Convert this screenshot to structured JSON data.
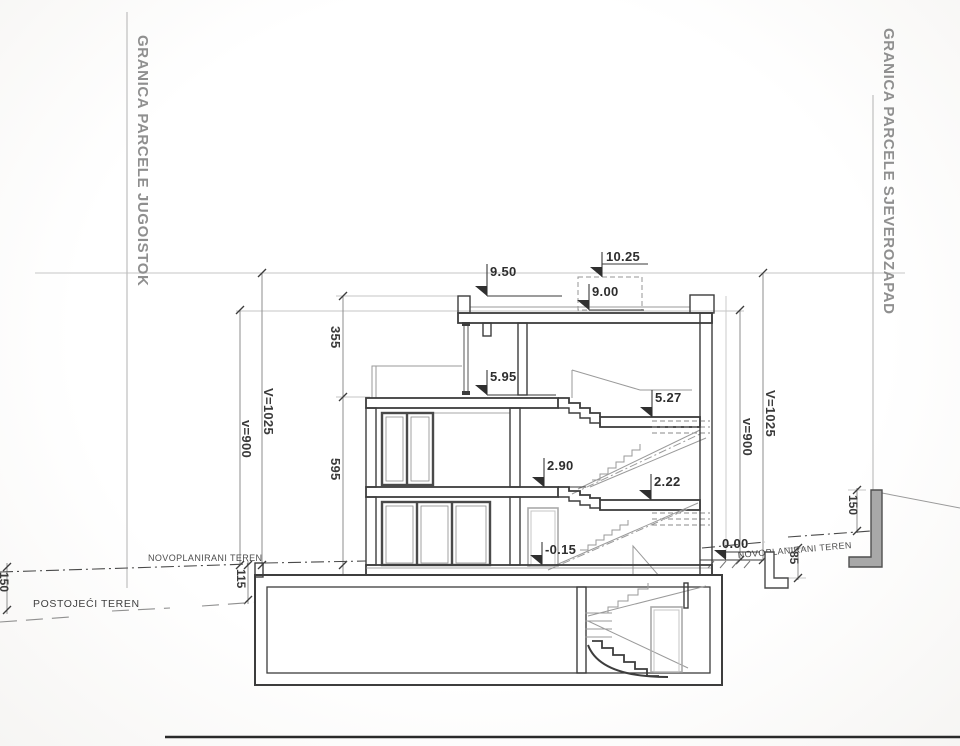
{
  "boundary": {
    "left": "GRANICA PARCELE JUGOISTOK",
    "right": "GRANICA PARCELE SJEVEROZAPAD"
  },
  "levels": {
    "stair_overrun": "10.25",
    "parapet": "9.50",
    "roof": "9.00",
    "top_floor": "5.95",
    "upper_landing": "5.27",
    "first_floor": "2.90",
    "lower_landing": "2.22",
    "ground_floor": "-0.15",
    "terrain_zero": "0.00"
  },
  "dimensions": {
    "roof_to_top_floor": "355",
    "top_floor_to_zero": "595",
    "left_total_V": "V=1025",
    "left_total_v": "v=900",
    "right_total_V": "V=1025",
    "right_total_v": "v=900",
    "terrain_step_left": "115",
    "terrain_drop_far_left": "150",
    "retaining_wall_right": "150",
    "terrain_step_right": "85"
  },
  "terrain": {
    "new_terrain_left": "NOVOPLANIRANI TEREN",
    "new_terrain_right": "NOVOPLANIRANI TEREN",
    "existing_terrain_left": "POSTOJEĆI TEREN"
  },
  "colors": {
    "ink_dark": "#3d3d3d",
    "ink_medium": "#8e8e8e",
    "ink_light": "#c6c6c6",
    "label_gray": "#8f8f8f",
    "wall_fill": "#a8a8a8",
    "background": "#fcfcfc"
  }
}
